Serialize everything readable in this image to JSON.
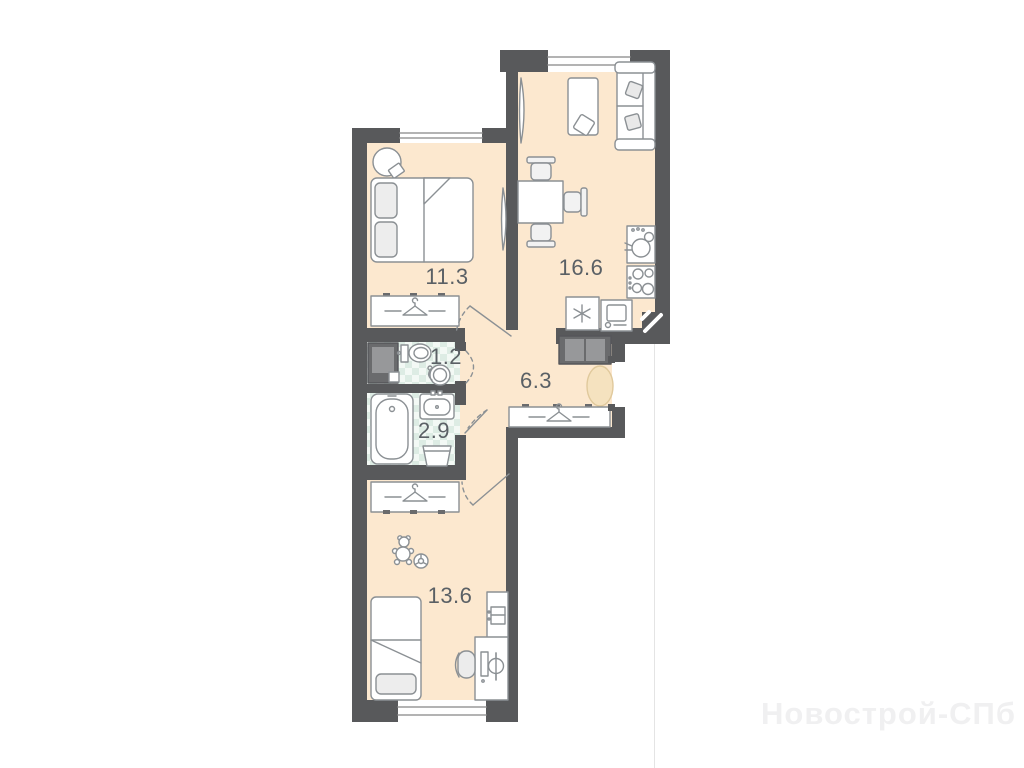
{
  "plan": {
    "title": "2-room apartment floor plan",
    "rooms": [
      {
        "name": "bedroom",
        "area_label": "11.3"
      },
      {
        "name": "living-kitchen",
        "area_label": "16.6"
      },
      {
        "name": "wc",
        "area_label": "1.2"
      },
      {
        "name": "bathroom",
        "area_label": "2.9"
      },
      {
        "name": "hallway",
        "area_label": "6.3"
      },
      {
        "name": "children-room",
        "area_label": "13.6"
      }
    ],
    "watermark": "Новострой-СПб",
    "colors": {
      "wall": "#58595b",
      "floor": "#fce8cf",
      "tile": "#f3f9f5",
      "tile_check": "#ddece4",
      "rug": "#f5e2bf",
      "outline": "#8b9094"
    },
    "icons": [
      "hanger-icon",
      "snowflake-icon",
      "burner-icon",
      "teddy-bear-icon",
      "ball-icon",
      "vent-shaft-icon"
    ]
  }
}
